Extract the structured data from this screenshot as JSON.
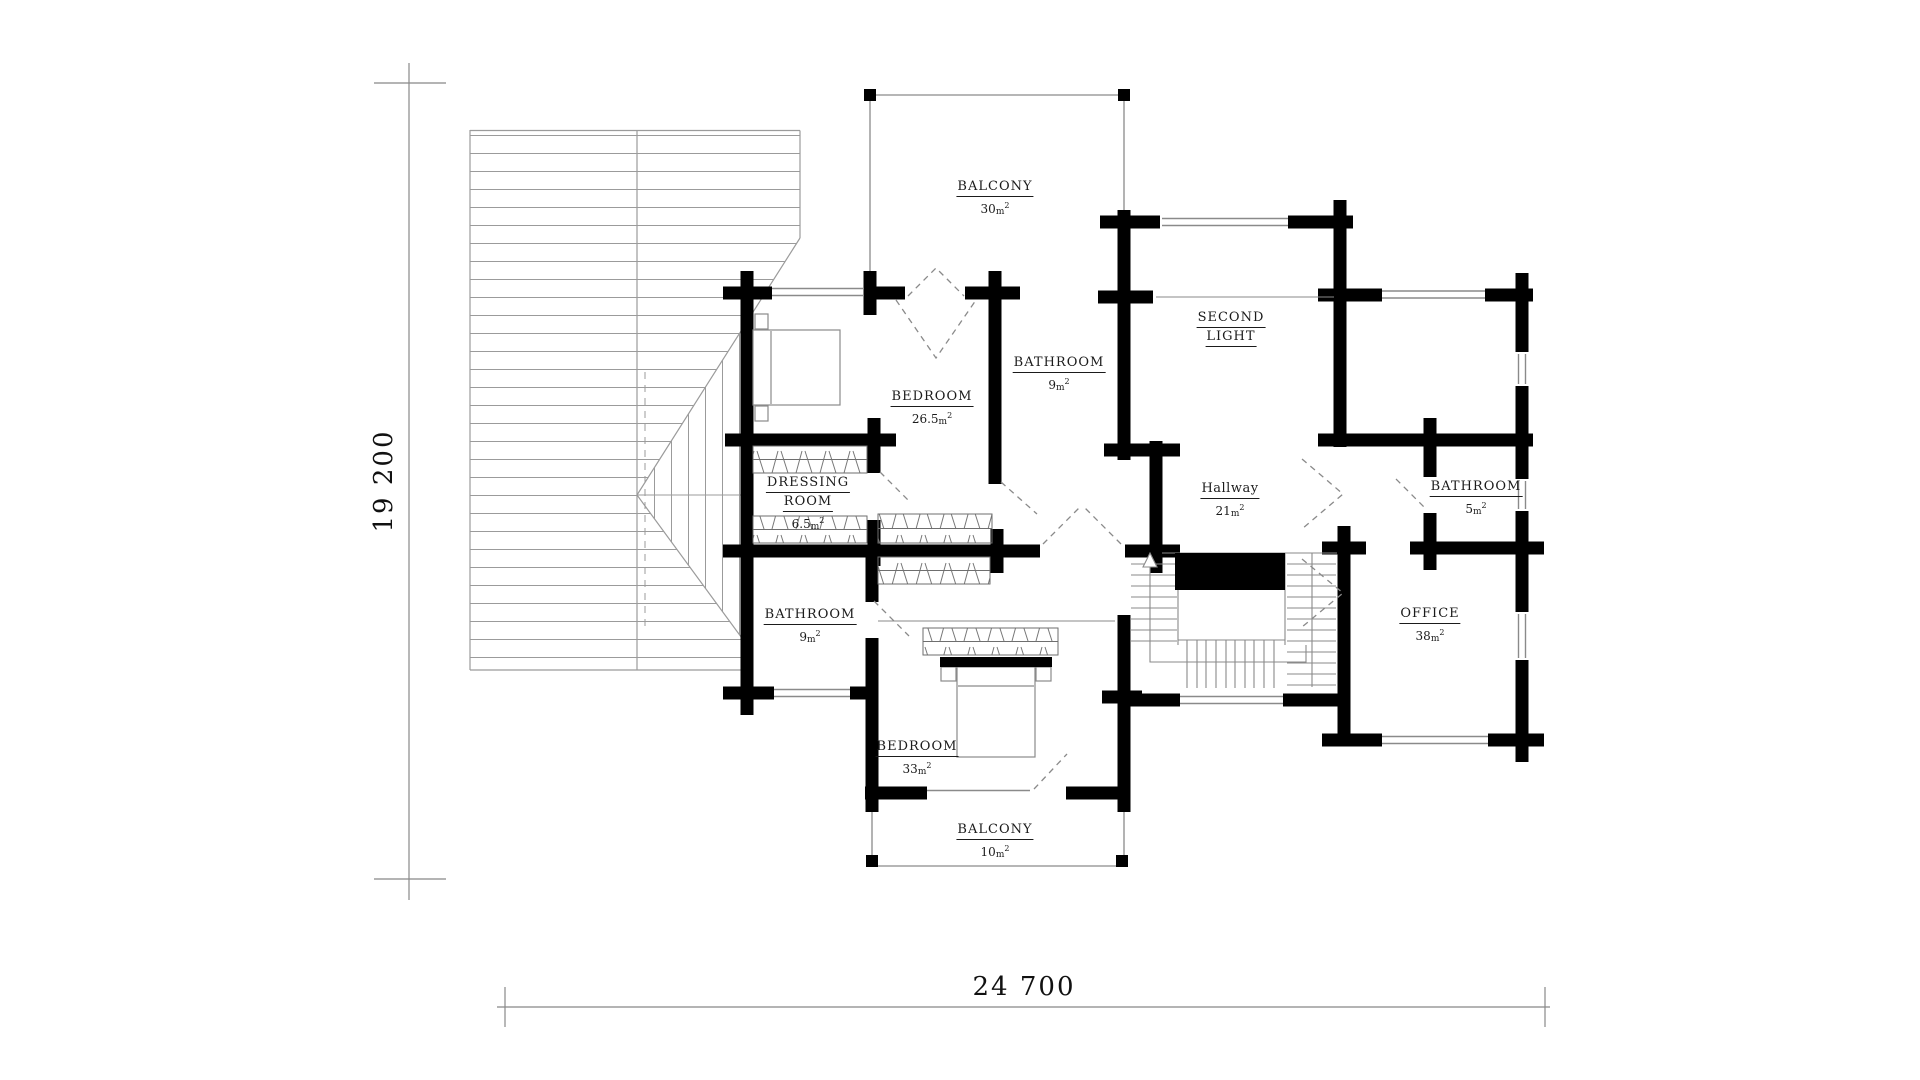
{
  "drawing": {
    "type": "floor-plan",
    "background": "#ffffff"
  },
  "dimensions": {
    "vertical": "19 200",
    "horizontal": "24 700"
  },
  "units": {
    "m": "m",
    "exp": "2"
  },
  "rooms": [
    {
      "id": "balcony-top",
      "name": "BALCONY",
      "area": "30"
    },
    {
      "id": "second-light",
      "name": "SECOND",
      "name2": "LIGHT"
    },
    {
      "id": "bedroom-west",
      "name": "BEDROOM",
      "area": "26.5"
    },
    {
      "id": "bathroom-top",
      "name": "BATHROOM",
      "area": "9"
    },
    {
      "id": "hallway",
      "name": "Hallway",
      "area": "21"
    },
    {
      "id": "dressing-room",
      "name": "DRESSING",
      "name2": "ROOM",
      "area": "6.5"
    },
    {
      "id": "bathroom-west",
      "name": "BATHROOM",
      "area": "9"
    },
    {
      "id": "bathroom-east",
      "name": "BATHROOM",
      "area": "5"
    },
    {
      "id": "office",
      "name": "OFFICE",
      "area": "38"
    },
    {
      "id": "bedroom-south",
      "name": "BEDROOM",
      "area": "33"
    },
    {
      "id": "balcony-bottom",
      "name": "BALCONY",
      "area": "10"
    }
  ],
  "colors": {
    "wall": "#000000",
    "thin-line": "#8a8a8a",
    "roof-line": "#9b9b9b",
    "text": "#1b1b1b"
  }
}
